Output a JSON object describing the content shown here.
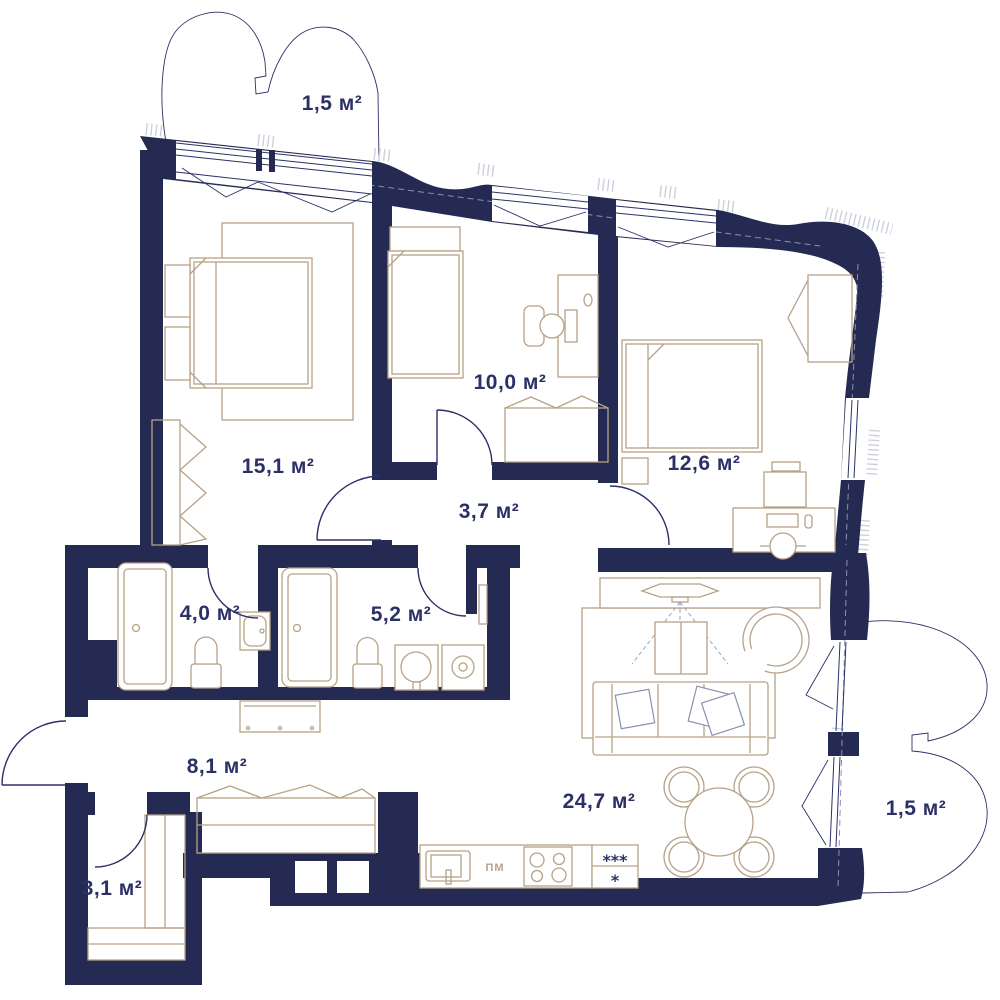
{
  "title": "Apartment floor plan",
  "units": "м²",
  "colors": {
    "walls": "#252a52",
    "furniture": "#b6a287",
    "labels": "#2b3166",
    "background": "#ffffff",
    "hatch_ticks": "#cdd0dc"
  },
  "rooms": [
    {
      "id": "balcony-top",
      "label": "1,5 м²"
    },
    {
      "id": "bedroom-main",
      "label": "15,1 м²"
    },
    {
      "id": "bedroom-kids",
      "label": "10,0 м²"
    },
    {
      "id": "bedroom-second",
      "label": "12,6 м²"
    },
    {
      "id": "hall-inner",
      "label": "3,7 м²"
    },
    {
      "id": "bathroom-small",
      "label": "4,0 м²"
    },
    {
      "id": "bathroom-large",
      "label": "5,2 м²"
    },
    {
      "id": "hallway-entry",
      "label": "8,1 м²"
    },
    {
      "id": "living-kitchen",
      "label": "24,7 м²"
    },
    {
      "id": "wardrobe-closet",
      "label": "3,1 м²"
    },
    {
      "id": "balcony-right",
      "label": "1,5 м²"
    }
  ],
  "kitchen": {
    "dishwasher_label": "ПМ",
    "fridge_freezer_label": "***",
    "fridge_label": "*"
  }
}
